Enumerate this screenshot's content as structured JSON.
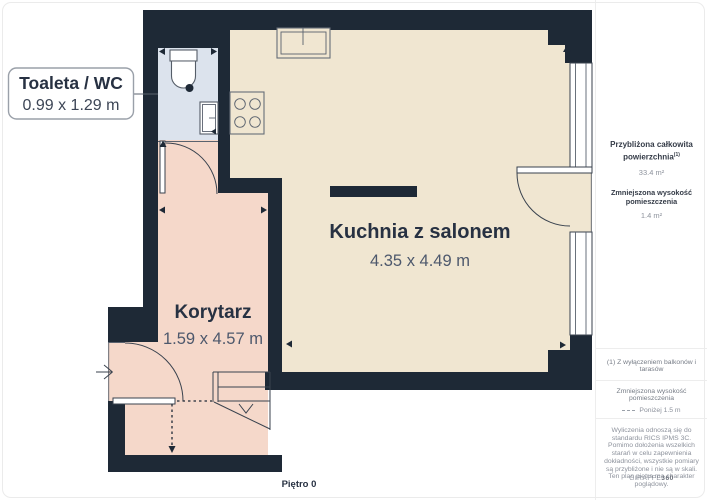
{
  "plan": {
    "floor_label": "Piętro 0",
    "callout": {
      "title": "Toaleta / WC",
      "dimensions": "0.99 x 1.29 m"
    },
    "rooms": [
      {
        "name": "Kuchnia z salonem",
        "dimensions": "4.35 x 4.49 m"
      },
      {
        "name": "Korytarz",
        "dimensions": "1.59 x 4.57 m"
      }
    ]
  },
  "sidebar": {
    "approx_area": {
      "label_line1": "Przybliżona całkowita",
      "label_line2": "powierzchnia",
      "footnote_mark": "(1)",
      "value": "33.4 m²"
    },
    "reduced_height": {
      "label": "Zmniejszona wysokość pomieszczenia",
      "value": "1.4 m²"
    },
    "footnote": "(1) Z wyłączeniem balkonów i tarasów",
    "legend": {
      "label": "Zmniejszona wysokość pomieszczenia",
      "value": "Poniżej 1.5 m"
    },
    "disclaimer": "Wyliczenia odnoszą się do standardu RICS IPMS 3C. Pomimo dołożenia wszelkich starań w celu zapewnienia dokładności, wszystkie pomiary są przybliżone i nie są w skali. Ten plan piętra ma charakter poglądowy.",
    "brand": {
      "name": "GIRAFFE",
      "suffix": "360"
    }
  },
  "colors": {
    "wall": "#1e2936",
    "kitchen_floor": "#f0e6d1",
    "corridor_floor": "#f5d8ca",
    "wc_floor": "#dce3ed"
  }
}
